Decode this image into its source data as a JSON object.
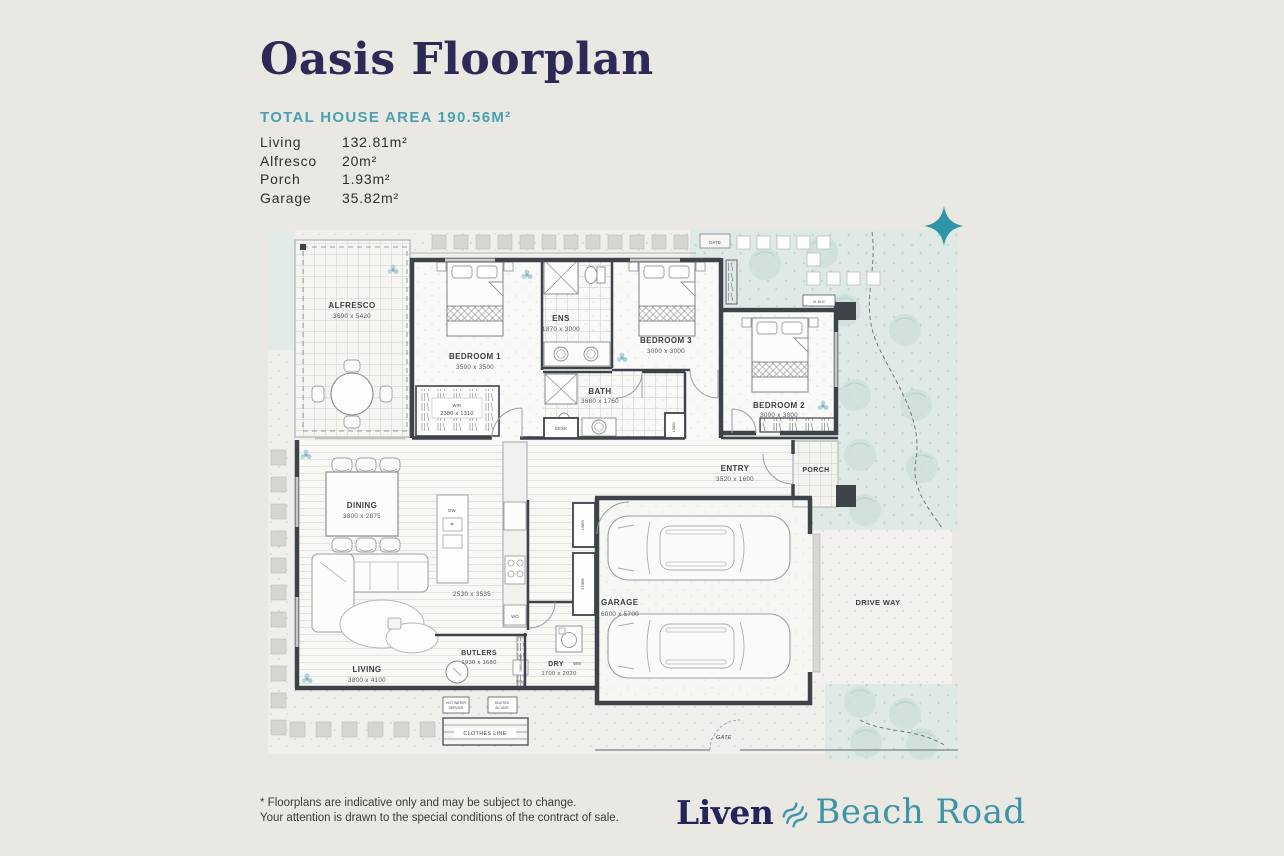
{
  "header": {
    "title": "Oasis Floorplan",
    "total_area": "TOTAL HOUSE AREA 190.56M²",
    "areas": [
      {
        "label": "Living",
        "value": "132.81m²"
      },
      {
        "label": "Alfresco",
        "value": "20m²"
      },
      {
        "label": "Porch",
        "value": "1.93m²"
      },
      {
        "label": "Garage",
        "value": "35.82m²"
      }
    ]
  },
  "plan": {
    "rooms": {
      "alfresco": {
        "name": "ALFRESCO",
        "dims": "3690 x 5420"
      },
      "bedroom1": {
        "name": "BEDROOM 1",
        "dims": "3500 x 3500"
      },
      "wir": {
        "name": "WIR",
        "dims": "2380 x 1310"
      },
      "ens": {
        "name": "ENS",
        "dims": "1870 x 3000"
      },
      "bedroom3": {
        "name": "BEDROOM 3",
        "dims": "3000 x 3000"
      },
      "bath": {
        "name": "BATH",
        "dims": "3680 x 1760"
      },
      "bedroom2": {
        "name": "BEDROOM 2",
        "dims": "3000 x 3000"
      },
      "entry": {
        "name": "ENTRY",
        "dims": "3520 x 1600"
      },
      "porch": {
        "name": "PORCH"
      },
      "dining": {
        "name": "DINING",
        "dims": "3800 x 2875"
      },
      "kitchen": {
        "dims": "2530 x 3535"
      },
      "living": {
        "name": "LIVING",
        "dims": "3800 x 4100"
      },
      "butlers": {
        "name": "BUTLERS",
        "dims": "1930 x 1680"
      },
      "dry": {
        "name": "DRY",
        "dims": "1700 x 2020"
      },
      "garage": {
        "name": "GARAGE",
        "dims": "6000 x 5700"
      },
      "driveway": {
        "name": "DRIVE WAY"
      }
    },
    "labels": {
      "gate_top": "GATE",
      "gate_bottom": "GATE",
      "mbox": "M. BOX",
      "desk": "DESK",
      "linen_hall": "LINEN",
      "linen_garage": "LINEN",
      "store": "STORE",
      "shelving": "SHELVING",
      "dw": "DW",
      "wo": "WO",
      "wm": "WM",
      "brm": "BRM",
      "hws_line1": "HOT WATER",
      "hws_line2": "SERVICE",
      "ac_line1": "DUCTED",
      "ac_line2": "AC UNIT",
      "clothes_line": "CLOTHES LINE"
    }
  },
  "footer": {
    "disclaimer_line1": "* Floorplans are indicative only and may be subject to change.",
    "disclaimer_line2": "Your attention is drawn to the special conditions of the contract of sale.",
    "brand_name": "Liven",
    "brand_project": "Beach Road"
  },
  "colors": {
    "page_bg": "#eae8e3",
    "title_navy": "#2d2a57",
    "accent_teal": "#4aa0ae",
    "brand_teal": "#3e93a5",
    "wall": "#3e434a",
    "garden": "#dfe9e5",
    "sparkle": "#2f96a8"
  }
}
